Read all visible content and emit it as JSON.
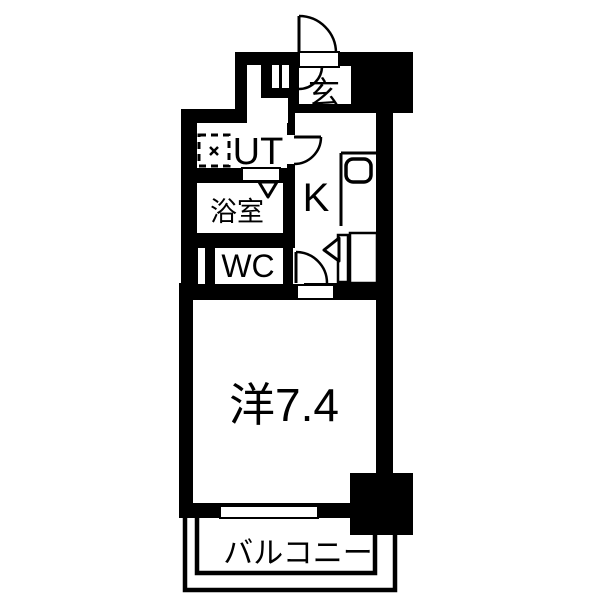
{
  "floorplan": {
    "rooms": {
      "entrance": "玄",
      "utility": "UT",
      "bathroom": "浴室",
      "toilet": "WC",
      "kitchen": "K",
      "main_room": "洋7.4",
      "balcony": "バルコニー"
    },
    "colors": {
      "wall": "#000000",
      "floor": "#ffffff"
    },
    "icons": {
      "washing_machine": "dashed-square-with-cross",
      "kitchen_sink": "rounded-rect",
      "door_swing": "quarter-arc",
      "bath_door_marker": "down-triangle",
      "kitchen_passage_marker": "left-triangle"
    }
  }
}
